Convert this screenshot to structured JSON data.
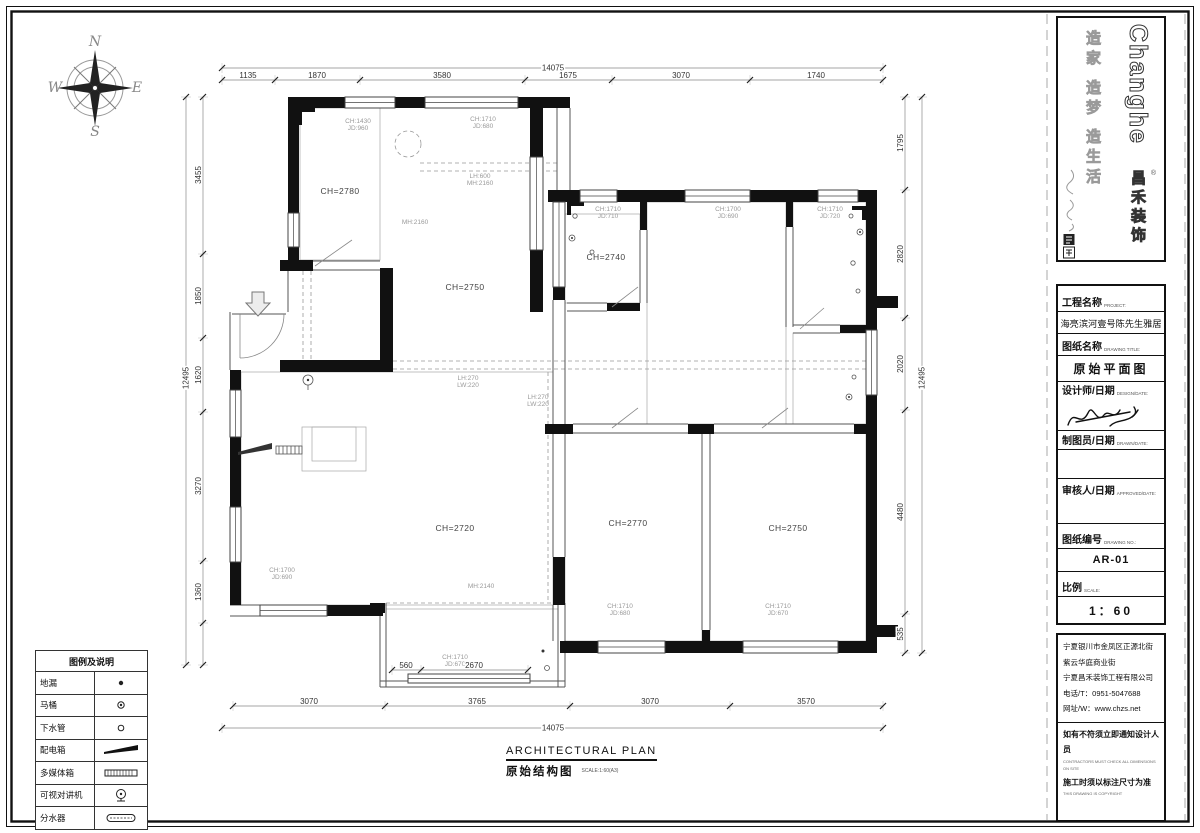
{
  "compass": {
    "n": "N",
    "e": "E",
    "s": "S",
    "w": "W"
  },
  "brand": {
    "logo_en": "Changhe",
    "logo_cn": "昌禾装饰",
    "reg_mark": "®",
    "slogan": "造家 造梦 造生活"
  },
  "title_block": {
    "rows": [
      {
        "label": "工程名称",
        "label_en": "PROJECT:",
        "value": "海亮滨河壹号陈先生雅居"
      },
      {
        "label": "图纸名称",
        "label_en": "DRAWING TITLE:",
        "value": "原始平面图"
      },
      {
        "label": "设计师/日期",
        "label_en": "DESIGN/DATE:",
        "value": ""
      },
      {
        "label": "制图员/日期",
        "label_en": "DRAWN/DATE:",
        "value": ""
      },
      {
        "label": "审核人/日期",
        "label_en": "APPROVED/DATE:",
        "value": ""
      },
      {
        "label": "图纸编号",
        "label_en": "DRAWING NO.:",
        "value": "AR-01"
      },
      {
        "label": "比例",
        "label_en": "SCALE:",
        "value": "1：60"
      }
    ],
    "address_lines": [
      "宁夏银川市金凤区正源北街",
      "紫云华庭商业街",
      "宁夏昌禾装饰工程有限公司",
      "电话/T：0951-5047688",
      "网址/W：www.chzs.net"
    ],
    "notes": [
      {
        "cn": "如有不符须立即通知设计人员",
        "en": "CONTRACTORS MUST CHECK ALL DIMENSIONS ON SITE"
      },
      {
        "cn": "施工时须以标注尺寸为准",
        "en": "THIS DRAWING IS COPYRIGHT"
      }
    ]
  },
  "plan_title": {
    "en": "ARCHITECTURAL PLAN",
    "cn": "原始结构图",
    "scale": "SCALE:1:60(A3)"
  },
  "legend": {
    "title": "图例及说明",
    "items": [
      {
        "label": "地漏",
        "symbol": "floor-drain"
      },
      {
        "label": "马桶",
        "symbol": "toilet"
      },
      {
        "label": "下水管",
        "symbol": "drain-pipe"
      },
      {
        "label": "配电箱",
        "symbol": "distribution-box"
      },
      {
        "label": "多媒体箱",
        "symbol": "multimedia-box"
      },
      {
        "label": "可视对讲机",
        "symbol": "video-intercom"
      },
      {
        "label": "分水器",
        "symbol": "water-manifold"
      }
    ]
  },
  "plan": {
    "rooms": [
      {
        "t": "CH=2780",
        "x": 340,
        "y": 194
      },
      {
        "t": "CH=2750",
        "x": 465,
        "y": 290
      },
      {
        "t": "CH=2740",
        "x": 606,
        "y": 260
      },
      {
        "t": "CH=2720",
        "x": 455,
        "y": 531
      },
      {
        "t": "CH=2770",
        "x": 628,
        "y": 526
      },
      {
        "t": "CH=2750",
        "x": 788,
        "y": 531
      }
    ],
    "notes": [
      {
        "x": 358,
        "y": 123,
        "lines": [
          "CH:1430",
          "JD:960"
        ]
      },
      {
        "x": 483,
        "y": 121,
        "lines": [
          "CH:1710",
          "JD:680"
        ]
      },
      {
        "x": 480,
        "y": 178,
        "lines": [
          "LH:600",
          "MH:2160"
        ]
      },
      {
        "x": 415,
        "y": 224,
        "lines": [
          "MH:2160"
        ]
      },
      {
        "x": 608,
        "y": 211,
        "lines": [
          "CH:1710",
          "JD:710"
        ]
      },
      {
        "x": 728,
        "y": 211,
        "lines": [
          "CH:1700",
          "JD:690"
        ]
      },
      {
        "x": 830,
        "y": 211,
        "lines": [
          "CH:1710",
          "JD:720"
        ]
      },
      {
        "x": 468,
        "y": 380,
        "lines": [
          "LH:270",
          "LW:220"
        ]
      },
      {
        "x": 538,
        "y": 399,
        "lines": [
          "LH:270",
          "LW:220"
        ]
      },
      {
        "x": 481,
        "y": 588,
        "lines": [
          "MH:2140"
        ]
      },
      {
        "x": 282,
        "y": 572,
        "lines": [
          "CH:1700",
          "JD:690"
        ]
      },
      {
        "x": 620,
        "y": 608,
        "lines": [
          "CH:1710",
          "JD:680"
        ]
      },
      {
        "x": 778,
        "y": 608,
        "lines": [
          "CH:1710",
          "JD:670"
        ]
      },
      {
        "x": 455,
        "y": 659,
        "lines": [
          "CH:1710",
          "JD:670"
        ]
      }
    ],
    "dims": [
      {
        "o": "h",
        "y": 68,
        "x1": 222,
        "x2": 883,
        "ticks": [
          222,
          883
        ],
        "labels": [
          {
            "t": "14075",
            "p": 553
          }
        ]
      },
      {
        "o": "h",
        "y": 80,
        "x1": 222,
        "x2": 883,
        "ticks": [
          222,
          275,
          360,
          525,
          612,
          750,
          883
        ],
        "labels": [
          {
            "t": "1135",
            "p": 248
          },
          {
            "t": "1870",
            "p": 317
          },
          {
            "t": "3580",
            "p": 442
          },
          {
            "t": "1675",
            "p": 568
          },
          {
            "t": "3070",
            "p": 681
          },
          {
            "t": "1740",
            "p": 816
          }
        ]
      },
      {
        "o": "h",
        "y": 706,
        "x1": 233,
        "x2": 883,
        "ticks": [
          233,
          385,
          570,
          730,
          883
        ],
        "labels": [
          {
            "t": "3070",
            "p": 309
          },
          {
            "t": "3765",
            "p": 477
          },
          {
            "t": "3070",
            "p": 650
          },
          {
            "t": "3570",
            "p": 806
          }
        ]
      },
      {
        "o": "h",
        "y": 728,
        "x1": 222,
        "x2": 883,
        "ticks": [
          222,
          883
        ],
        "labels": [
          {
            "t": "14075",
            "p": 553
          }
        ]
      },
      {
        "o": "v",
        "x": 203,
        "y1": 97,
        "y2": 665,
        "ticks": [
          97,
          254,
          338,
          412,
          561,
          623,
          665
        ],
        "labels": [
          {
            "t": "3455",
            "p": 175
          },
          {
            "t": "1850",
            "p": 296
          },
          {
            "t": "1620",
            "p": 375
          },
          {
            "t": "3270",
            "p": 486
          },
          {
            "t": "1360",
            "p": 592
          }
        ]
      },
      {
        "o": "v",
        "x": 186,
        "y1": 97,
        "y2": 665,
        "ticks": [
          97,
          665
        ],
        "labels": [
          {
            "t": "12495",
            "p": 378
          }
        ]
      },
      {
        "o": "v",
        "x": 905,
        "y1": 97,
        "y2": 653,
        "ticks": [
          97,
          190,
          318,
          410,
          614,
          653
        ],
        "labels": [
          {
            "t": "1795",
            "p": 143
          },
          {
            "t": "2820",
            "p": 254
          },
          {
            "t": "2020",
            "p": 364
          },
          {
            "t": "4480",
            "p": 512
          },
          {
            "t": "535",
            "p": 634
          }
        ]
      },
      {
        "o": "v",
        "x": 922,
        "y1": 97,
        "y2": 653,
        "ticks": [
          97,
          653
        ],
        "labels": [
          {
            "t": "12495",
            "p": 378
          }
        ]
      },
      {
        "o": "h",
        "y": 670,
        "x1": 392,
        "x2": 528,
        "ticks": [
          392,
          421,
          528
        ],
        "labels": [
          {
            "t": "560",
            "p": 406
          },
          {
            "t": "2670",
            "p": 474
          }
        ]
      }
    ]
  }
}
